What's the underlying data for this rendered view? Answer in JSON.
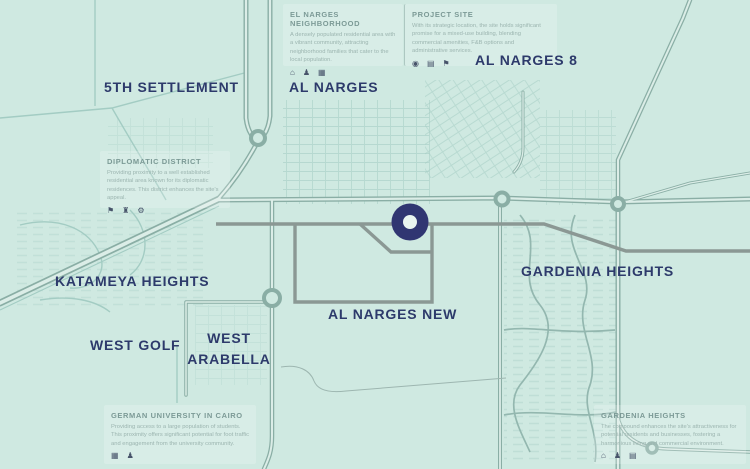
{
  "colors": {
    "background": "#cfe9e1",
    "label_navy": "#2d3a6b",
    "marker_navy": "#303672",
    "road_dark_gray": "#8b9894",
    "road_teal": "#8aaea5",
    "card_title": "#7c9a96",
    "card_body_text": "#9cb5b0"
  },
  "labels": {
    "fifth_settlement": "5TH SETTLEMENT",
    "al_narges": "AL NARGES",
    "al_narges_8": "AL NARGES 8",
    "katameya_heights": "KATAMEYA HEIGHTS",
    "gardenia_heights": "GARDENIA HEIGHTS",
    "al_narges_new": "AL NARGES NEW",
    "west_golf": "WEST GOLF",
    "west_arabella": {
      "line1": "WEST",
      "line2": "ARABELLA"
    }
  },
  "marker": {
    "name": "project-site-marker",
    "color": "#303672"
  },
  "cards": [
    {
      "title": "EL NARGES NEIGHBORHOOD",
      "body": "A densely populated residential area with a vibrant community, attracting neighborhood families that cater to the local population.",
      "icons": [
        {
          "name": "home-icon",
          "glyph": "⌂"
        },
        {
          "name": "community-icon",
          "glyph": "♟"
        },
        {
          "name": "buildings-icon",
          "glyph": "▦"
        }
      ]
    },
    {
      "title": "PROJECT SITE",
      "body": "With its strategic location, the site holds significant promise for a mixed-use building, blending commercial amenities, F&B options and administrative services.",
      "icons": [
        {
          "name": "location-icon",
          "glyph": "◉"
        },
        {
          "name": "storefront-icon",
          "glyph": "▤"
        },
        {
          "name": "services-icon",
          "glyph": "⚑"
        }
      ]
    },
    {
      "title": "DIPLOMATIC DISTRICT",
      "body": "Providing proximity to a well established residential area known for its diplomatic residences. This district enhances the site's appeal.",
      "icons": [
        {
          "name": "flag-icon",
          "glyph": "⚑"
        },
        {
          "name": "landmark-icon",
          "glyph": "♜"
        },
        {
          "name": "car-icon",
          "glyph": "⚙"
        }
      ]
    },
    {
      "title": "GERMAN UNIVERSITY IN CAIRO",
      "body": "Providing access to a large population of students. This proximity offers significant potential for foot traffic and engagement from the university community.",
      "icons": [
        {
          "name": "university-building-icon",
          "glyph": "▦"
        },
        {
          "name": "student-icon",
          "glyph": "♟"
        }
      ]
    },
    {
      "title": "GARDENIA HEIGHTS",
      "body": "The compound enhances the site's attractiveness for potential residents and businesses, fostering a harmonious living and commercial environment.",
      "icons": [
        {
          "name": "home-icon",
          "glyph": "⌂"
        },
        {
          "name": "community-icon",
          "glyph": "♟"
        },
        {
          "name": "building-icon",
          "glyph": "▤"
        }
      ]
    }
  ]
}
